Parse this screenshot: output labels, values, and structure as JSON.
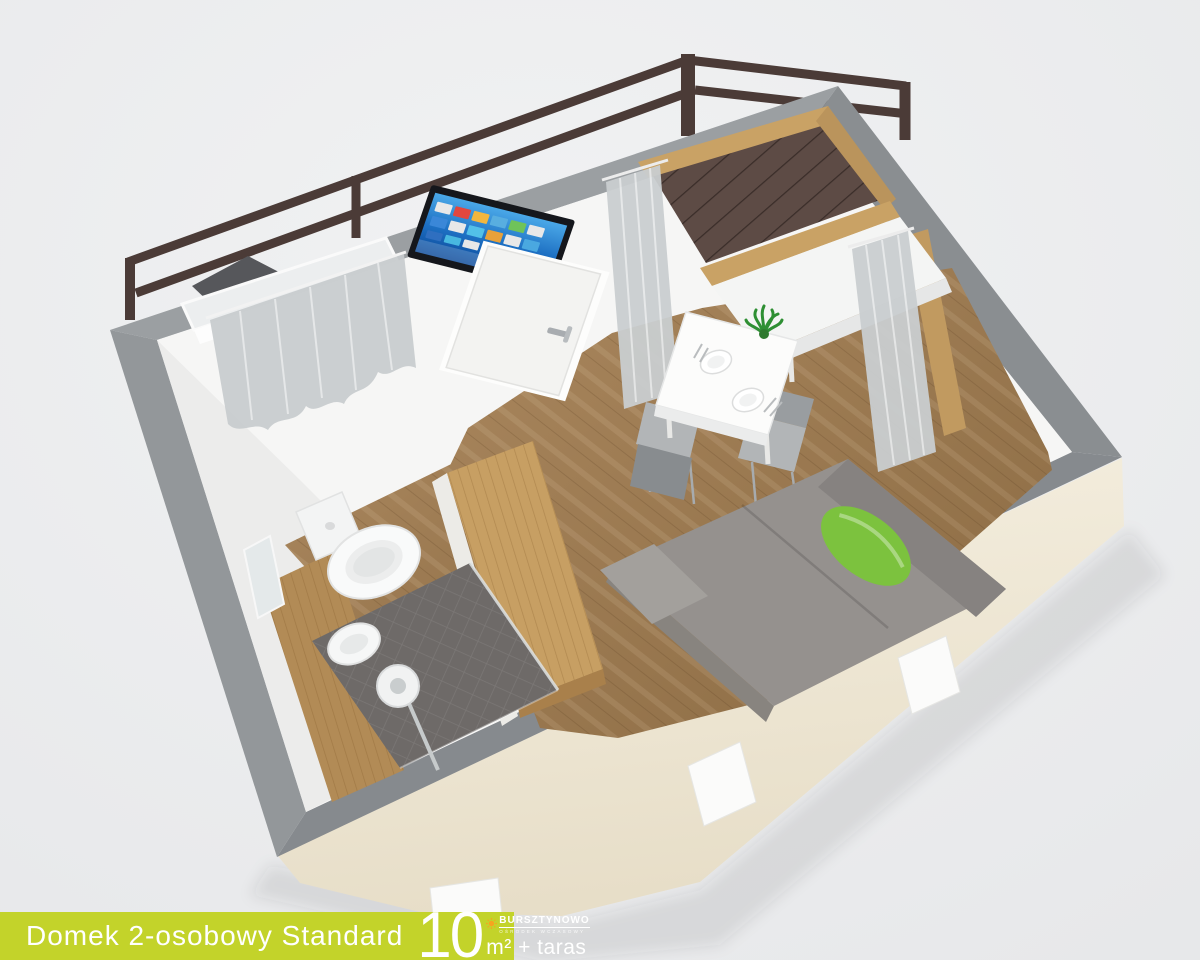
{
  "caption": {
    "title": "Domek 2-osobowy Standard",
    "area_value": "10",
    "area_unit": "m² + taras"
  },
  "logo": {
    "brand": "BURSZTYNOWO",
    "tagline": "OŚRODEK WCZASOWY",
    "sun_color": "#f6a41f"
  },
  "scene": {
    "background": "#edeeef",
    "colors": {
      "wall_top": "#8f9396",
      "interior_wall": "#f6f6f5",
      "exterior_facade": "#f1ead8",
      "floor_wood": "#9a7950",
      "counter_wood": "#c79f63",
      "window_frame_wood": "#c9a265",
      "terrace_deck": "#5d4b45",
      "railing": "#4b3b37",
      "sofa": "#95918e",
      "cushion_green": "#7cc23e",
      "curtain": "#c9cdd0",
      "tv_screen": "#1d6fc2",
      "caption_bar": "#c3d32a"
    },
    "labels": {
      "railing": "Terrace railing",
      "terrace_deck": "Terrace decking",
      "terrace_chair": "Terrace chair",
      "facade": "Exterior wall",
      "walls": "Wall tops (cutaway)",
      "bathroom_window": "Bathroom window with curtain",
      "toilet": "Toilet",
      "bidet": "Bidet",
      "shower": "Shower",
      "mirror": "Mirror",
      "wardrobe": "Wardrobe counter",
      "tv": "Wall-mounted TV",
      "door": "Entrance door",
      "corner_window": "Corner window with curtains",
      "dining_table": "Dining table for two",
      "chair": "Dining chair",
      "plant": "Potted plant",
      "sofa": "Sofa bed with green cushion",
      "feet": "Foundation blocks"
    }
  }
}
